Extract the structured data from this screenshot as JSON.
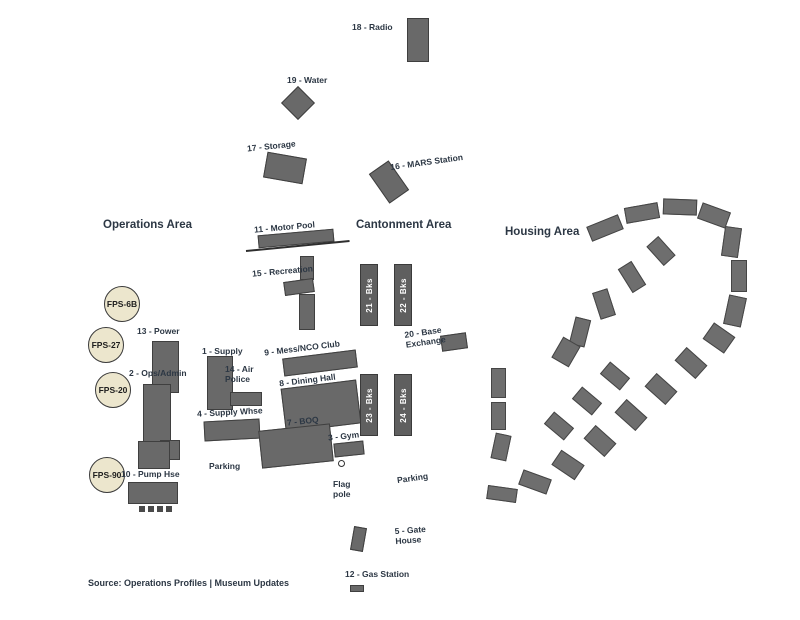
{
  "colors": {
    "building_fill": "#696969",
    "building_stroke": "#3f3f3f",
    "barracks_fill": "#5f5f5f",
    "barracks_text": "#ffffff",
    "label_text": "#2c3744",
    "radar_fill": "#ece6cd",
    "radar_stroke": "#3a3a3a",
    "background": "#ffffff"
  },
  "area_titles": [
    {
      "name": "operations-area-title",
      "label": "Operations Area",
      "x": 103,
      "y": 219
    },
    {
      "name": "cantonment-area-title",
      "label": "Cantonment Area",
      "x": 356,
      "y": 219
    },
    {
      "name": "housing-area-title",
      "label": "Housing Area",
      "x": 505,
      "y": 226
    }
  ],
  "radars": [
    {
      "name": "radar-fps-6b",
      "label": "FPS-6B",
      "cx": 122,
      "cy": 304
    },
    {
      "name": "radar-fps-27",
      "label": "FPS-27",
      "cx": 106,
      "cy": 345
    },
    {
      "name": "radar-fps-20",
      "label": "FPS-20",
      "cx": 113,
      "cy": 390
    },
    {
      "name": "radar-fps-90",
      "label": "FPS-90",
      "cx": 107,
      "cy": 475
    }
  ],
  "radar_radius": 18,
  "barracks": [
    {
      "name": "barracks-21",
      "label": "21 - Bks",
      "x": 360,
      "y": 264,
      "w": 18,
      "h": 62
    },
    {
      "name": "barracks-22",
      "label": "22 - Bks",
      "x": 394,
      "y": 264,
      "w": 18,
      "h": 62
    },
    {
      "name": "barracks-23",
      "label": "23 - Bks",
      "x": 360,
      "y": 374,
      "w": 18,
      "h": 62
    },
    {
      "name": "barracks-24",
      "label": "24 - Bks",
      "x": 394,
      "y": 374,
      "w": 18,
      "h": 62
    }
  ],
  "labels": [
    {
      "name": "label-18-radio",
      "text": "18 - Radio",
      "x": 352,
      "y": 22,
      "rot": 0
    },
    {
      "name": "label-19-water",
      "text": "19 - Water",
      "x": 287,
      "y": 75,
      "rot": 0
    },
    {
      "name": "label-17-storage",
      "text": "17 - Storage",
      "x": 247,
      "y": 141,
      "rot": -6
    },
    {
      "name": "label-16-mars",
      "text": "16 - MARS Station",
      "x": 390,
      "y": 157,
      "rot": -8
    },
    {
      "name": "label-11-motor-pool",
      "text": "11 - Motor Pool",
      "x": 254,
      "y": 222,
      "rot": -5
    },
    {
      "name": "label-15-recreation",
      "text": "15 - Recreation",
      "x": 252,
      "y": 266,
      "rot": -5
    },
    {
      "name": "label-13-power",
      "text": "13 - Power",
      "x": 137,
      "y": 326,
      "rot": 0
    },
    {
      "name": "label-1-supply",
      "text": "1 - Supply",
      "x": 202,
      "y": 346,
      "rot": 0
    },
    {
      "name": "label-9-mess-nco",
      "text": "9 - Mess/NCO Club",
      "x": 264,
      "y": 343,
      "rot": -7
    },
    {
      "name": "label-2-ops-admin",
      "text": "2 - Ops/Admin",
      "x": 129,
      "y": 368,
      "rot": 0
    },
    {
      "name": "label-14-air-police",
      "text": "14 - Air\nPolice",
      "x": 225,
      "y": 364,
      "rot": 0
    },
    {
      "name": "label-8-dining-hall",
      "text": "8 - Dining Hall",
      "x": 279,
      "y": 375,
      "rot": -7
    },
    {
      "name": "label-4-supply-whse",
      "text": "4 - Supply Whse",
      "x": 197,
      "y": 407,
      "rot": -3
    },
    {
      "name": "label-7-boq",
      "text": "7 - BOQ",
      "x": 287,
      "y": 416,
      "rot": -6
    },
    {
      "name": "label-3-gym",
      "text": "3 - Gym",
      "x": 328,
      "y": 431,
      "rot": -6
    },
    {
      "name": "label-20-base-exchange",
      "text": "20 - Base\nExchange",
      "x": 405,
      "y": 327,
      "rot": -8
    },
    {
      "name": "label-parking-ops",
      "text": "Parking",
      "x": 209,
      "y": 461,
      "rot": 0
    },
    {
      "name": "label-parking-cant",
      "text": "Parking",
      "x": 397,
      "y": 473,
      "rot": -8
    },
    {
      "name": "label-flagpole",
      "text": "Flag\npole",
      "x": 333,
      "y": 479,
      "rot": 0
    },
    {
      "name": "label-10-pump-hse",
      "text": "10 - Pump Hse",
      "x": 121,
      "y": 469,
      "rot": 0
    },
    {
      "name": "label-5-gate-house",
      "text": "5 - Gate\nHouse",
      "x": 395,
      "y": 525,
      "rot": -4
    },
    {
      "name": "label-12-gas-station",
      "text": "12 - Gas Station",
      "x": 345,
      "y": 569,
      "rot": 0
    }
  ],
  "buildings": [
    {
      "name": "bldg-18",
      "x": 407,
      "y": 18,
      "w": 22,
      "h": 44,
      "rot": 0
    },
    {
      "name": "bldg-19-water-tower",
      "x": 286,
      "y": 91,
      "w": 24,
      "h": 24,
      "rot": 45
    },
    {
      "name": "bldg-17",
      "x": 265,
      "y": 155,
      "w": 40,
      "h": 26,
      "rot": 10
    },
    {
      "name": "bldg-16",
      "x": 377,
      "y": 164,
      "w": 24,
      "h": 36,
      "rot": -35
    },
    {
      "name": "bldg-11",
      "x": 258,
      "y": 232,
      "w": 76,
      "h": 13,
      "rot": -5
    },
    {
      "name": "bldg-mid-upper",
      "x": 300,
      "y": 256,
      "w": 14,
      "h": 24,
      "rot": 0
    },
    {
      "name": "bldg-15a",
      "x": 284,
      "y": 280,
      "w": 30,
      "h": 14,
      "rot": -8
    },
    {
      "name": "bldg-15b",
      "x": 299,
      "y": 294,
      "w": 16,
      "h": 36,
      "rot": 0
    },
    {
      "name": "bldg-13",
      "x": 152,
      "y": 341,
      "w": 27,
      "h": 52,
      "rot": 0
    },
    {
      "name": "bldg-2",
      "x": 143,
      "y": 384,
      "w": 28,
      "h": 58,
      "rot": 0
    },
    {
      "name": "bldg-2-annex",
      "x": 160,
      "y": 440,
      "w": 20,
      "h": 20,
      "rot": 0
    },
    {
      "name": "bldg-1",
      "x": 207,
      "y": 356,
      "w": 26,
      "h": 54,
      "rot": 0
    },
    {
      "name": "bldg-14",
      "x": 230,
      "y": 392,
      "w": 32,
      "h": 14,
      "rot": 0
    },
    {
      "name": "bldg-9",
      "x": 283,
      "y": 354,
      "w": 74,
      "h": 18,
      "rot": -7
    },
    {
      "name": "bldg-8",
      "x": 283,
      "y": 384,
      "w": 76,
      "h": 44,
      "rot": -7
    },
    {
      "name": "bldg-4",
      "x": 204,
      "y": 420,
      "w": 56,
      "h": 20,
      "rot": -3
    },
    {
      "name": "bldg-7",
      "x": 260,
      "y": 427,
      "w": 72,
      "h": 38,
      "rot": -6
    },
    {
      "name": "bldg-3",
      "x": 334,
      "y": 442,
      "w": 30,
      "h": 14,
      "rot": -6
    },
    {
      "name": "bldg-20",
      "x": 441,
      "y": 334,
      "w": 26,
      "h": 16,
      "rot": -8
    },
    {
      "name": "bldg-10a",
      "x": 138,
      "y": 441,
      "w": 32,
      "h": 28,
      "rot": 0
    },
    {
      "name": "bldg-10b",
      "x": 128,
      "y": 482,
      "w": 50,
      "h": 22,
      "rot": 0
    },
    {
      "name": "bldg-gate-house",
      "x": 352,
      "y": 527,
      "w": 13,
      "h": 24,
      "rot": 10
    },
    {
      "name": "bldg-gas-station",
      "x": 350,
      "y": 585,
      "w": 14,
      "h": 7,
      "rot": 0
    }
  ],
  "housing_units": [
    [
      588,
      220,
      34,
      16,
      -22
    ],
    [
      625,
      205,
      34,
      16,
      -10
    ],
    [
      663,
      199,
      34,
      16,
      2
    ],
    [
      699,
      207,
      30,
      17,
      20
    ],
    [
      723,
      227,
      17,
      30,
      8
    ],
    [
      731,
      260,
      16,
      32,
      0
    ],
    [
      726,
      296,
      18,
      30,
      12
    ],
    [
      706,
      328,
      26,
      20,
      35
    ],
    [
      677,
      354,
      28,
      18,
      42
    ],
    [
      647,
      380,
      28,
      18,
      42
    ],
    [
      617,
      406,
      28,
      18,
      42
    ],
    [
      586,
      432,
      28,
      18,
      42
    ],
    [
      554,
      456,
      28,
      18,
      34
    ],
    [
      520,
      474,
      30,
      16,
      20
    ],
    [
      487,
      487,
      30,
      14,
      8
    ],
    [
      491,
      368,
      15,
      30,
      0
    ],
    [
      491,
      402,
      15,
      28,
      0
    ],
    [
      493,
      434,
      16,
      26,
      12
    ],
    [
      546,
      418,
      26,
      16,
      40
    ],
    [
      574,
      393,
      26,
      16,
      40
    ],
    [
      602,
      368,
      26,
      16,
      40
    ],
    [
      572,
      318,
      16,
      28,
      14
    ],
    [
      596,
      290,
      16,
      28,
      -18
    ],
    [
      624,
      263,
      16,
      28,
      -32
    ],
    [
      653,
      238,
      16,
      26,
      -42
    ],
    [
      556,
      340,
      20,
      24,
      30
    ]
  ],
  "fuel_tanks": [
    [
      139,
      506
    ],
    [
      148,
      506
    ],
    [
      157,
      506
    ],
    [
      166,
      506
    ]
  ],
  "flagpole": {
    "cx": 341,
    "cy": 463
  },
  "road": {
    "x1": 246,
    "y1": 250,
    "x2": 350,
    "y2": 240
  },
  "caption": {
    "text": "Source: Operations Profiles | Museum Updates",
    "x": 88,
    "y": 578
  }
}
